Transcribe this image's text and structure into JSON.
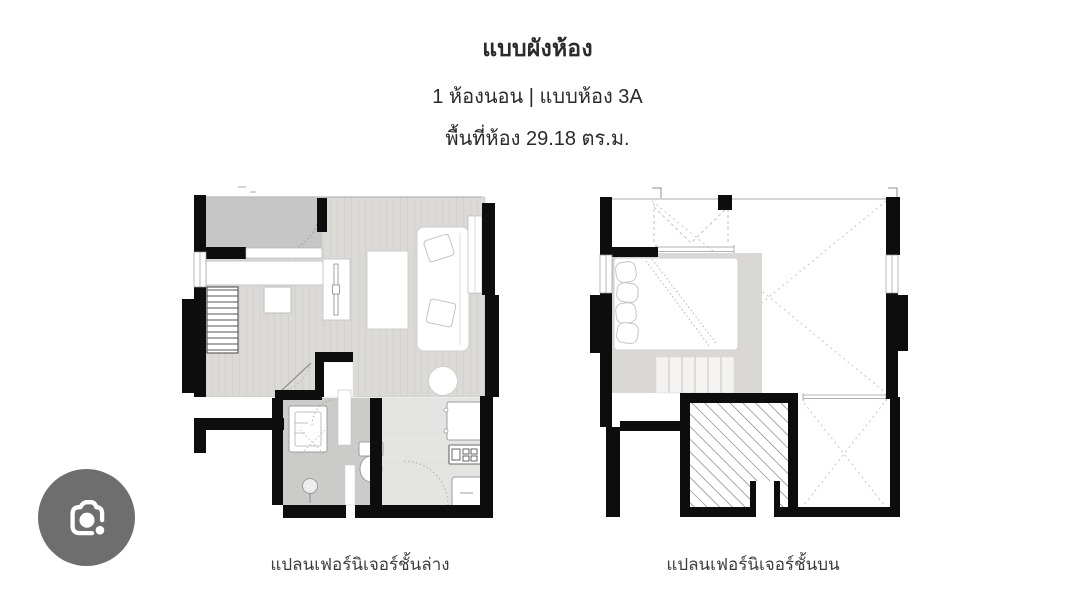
{
  "header": {
    "title": "แบบผังห้อง",
    "subtitle": "1 ห้องนอน | แบบห้อง 3A",
    "area": "พื้นที่ห้อง 29.18 ตร.ม."
  },
  "plans": {
    "lower": {
      "caption": "แปลนเฟอร์นิเจอร์ชั้นล่าง"
    },
    "upper": {
      "caption": "แปลนเฟอร์นิเจอร์ชั้นบน"
    }
  },
  "controls": {
    "camera_button": {
      "icon": "camera-lens-icon"
    }
  },
  "colors": {
    "wall": "#0d0d0d",
    "floor_main": "#dbdad7",
    "floor_balcony": "#c6c6c6",
    "floor_bathroom": "#cbcbca",
    "floor_kitchen": "#e4e4e2",
    "bed_rug": "#d9d8d5",
    "camera_button_bg": "#6e6e6e",
    "text_primary": "#2b2b2b",
    "text_caption": "#3c3c3c"
  }
}
